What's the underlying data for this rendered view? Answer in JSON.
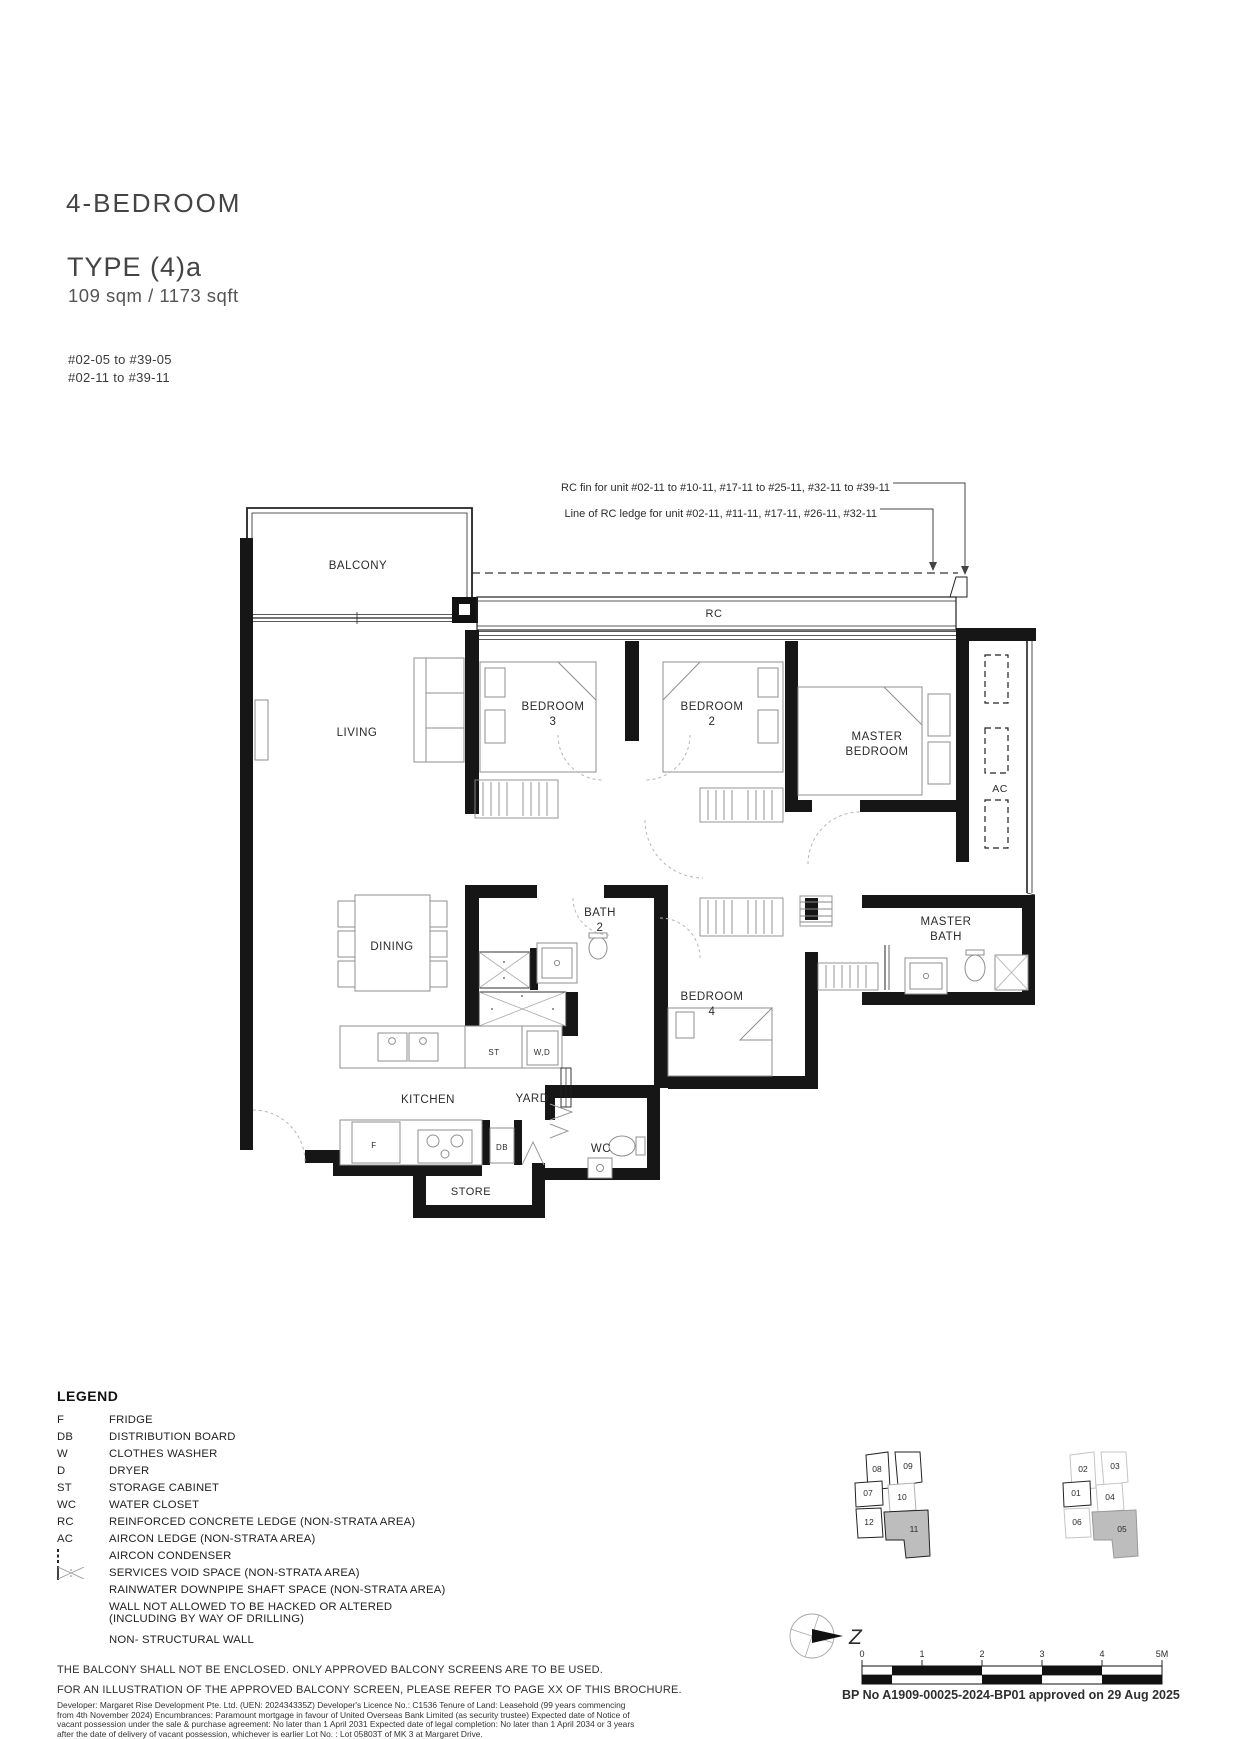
{
  "header": {
    "title": "4-BEDROOM",
    "type": "TYPE (4)a",
    "area": "109 sqm / 1173 sqft",
    "unit_ranges": [
      "#02-05 to #39-05",
      "#02-11 to #39-11"
    ]
  },
  "annotations": {
    "rc_fin": "RC fin for unit #02-11 to #10-11, #17-11 to #25-11, #32-11 to #39-11",
    "rc_ledge": "Line of RC ledge for unit #02-11, #11-11, #17-11, #26-11, #32-11"
  },
  "plan": {
    "rooms": {
      "balcony": "BALCONY",
      "living": "LIVING",
      "dining": "DINING",
      "kitchen": "KITCHEN",
      "yard": "YARD",
      "wc": "WC",
      "store": "STORE",
      "rc": "RC",
      "ac": "AC",
      "bedroom3": [
        "BEDROOM",
        "3"
      ],
      "bedroom2": [
        "BEDROOM",
        "2"
      ],
      "bedroom4": [
        "BEDROOM",
        "4"
      ],
      "master_bedroom": [
        "MASTER",
        "BEDROOM"
      ],
      "bath2": [
        "BATH",
        "2"
      ],
      "master_bath": [
        "MASTER",
        "BATH"
      ]
    },
    "fixtures": {
      "fridge": "F",
      "distribution_board": "DB",
      "storage": "ST",
      "washer_dryer": "W,D"
    }
  },
  "legend": {
    "heading": "LEGEND",
    "abbreviations": [
      {
        "abbr": "F",
        "label": "FRIDGE"
      },
      {
        "abbr": "DB",
        "label": "DISTRIBUTION BOARD"
      },
      {
        "abbr": "W",
        "label": "CLOTHES WASHER"
      },
      {
        "abbr": "D",
        "label": "DRYER"
      },
      {
        "abbr": "ST",
        "label": "STORAGE CABINET"
      },
      {
        "abbr": "WC",
        "label": "WATER CLOSET"
      },
      {
        "abbr": "RC",
        "label": "REINFORCED CONCRETE LEDGE (NON-STRATA AREA)"
      },
      {
        "abbr": "AC",
        "label": "AIRCON LEDGE (NON-STRATA AREA)"
      }
    ],
    "symbols": [
      {
        "label": "AIRCON CONDENSER"
      },
      {
        "label": "SERVICES VOID SPACE (NON-STRATA AREA)"
      },
      {
        "label": "RAINWATER DOWNPIPE SHAFT SPACE (NON-STRATA AREA)"
      },
      {
        "label": "WALL NOT ALLOWED TO BE HACKED OR ALTERED",
        "label2": "(INCLUDING BY WAY OF DRILLING)"
      },
      {
        "label": "NON- STRUCTURAL WALL"
      }
    ]
  },
  "notes": [
    "THE BALCONY SHALL NOT BE ENCLOSED. ONLY APPROVED BALCONY SCREENS ARE TO BE USED.",
    "FOR AN ILLUSTRATION OF THE APPROVED BALCONY SCREEN, PLEASE REFER TO PAGE XX OF THIS BROCHURE."
  ],
  "disclaimer": "Developer: Margaret Rise Development Pte. Ltd. (UEN: 202434335Z)  Developer's Licence No.: C1536  Tenure of Land: Leasehold (99 years commencing from 4th November 2024)  Encumbrances: Paramount mortgage in favour of United Overseas Bank Limited (as security trustee)  Expected date of Notice of vacant possession under the sale & purchase agreement: No later than 1 April 2031  Expected date of legal completion: No later than 1 April 2034 or 3 years after the date of delivery of vacant possession, whichever is earlier  Lot No. : Lot 05803T of MK 3 at Margaret Drive.",
  "approval": "BP No A1909-00025-2024-BP01 approved on 29 Aug 2025",
  "key_plans": {
    "left": {
      "units": [
        "08",
        "09",
        "07",
        "10",
        "12",
        "11"
      ],
      "highlighted": "11"
    },
    "right": {
      "units": [
        "02",
        "03",
        "01",
        "04",
        "06",
        "05"
      ],
      "highlighted": "05"
    }
  },
  "scale_bar": {
    "ticks": [
      "0",
      "1",
      "2",
      "3",
      "4",
      "5M"
    ]
  },
  "compass": {
    "north_label": "Z"
  }
}
